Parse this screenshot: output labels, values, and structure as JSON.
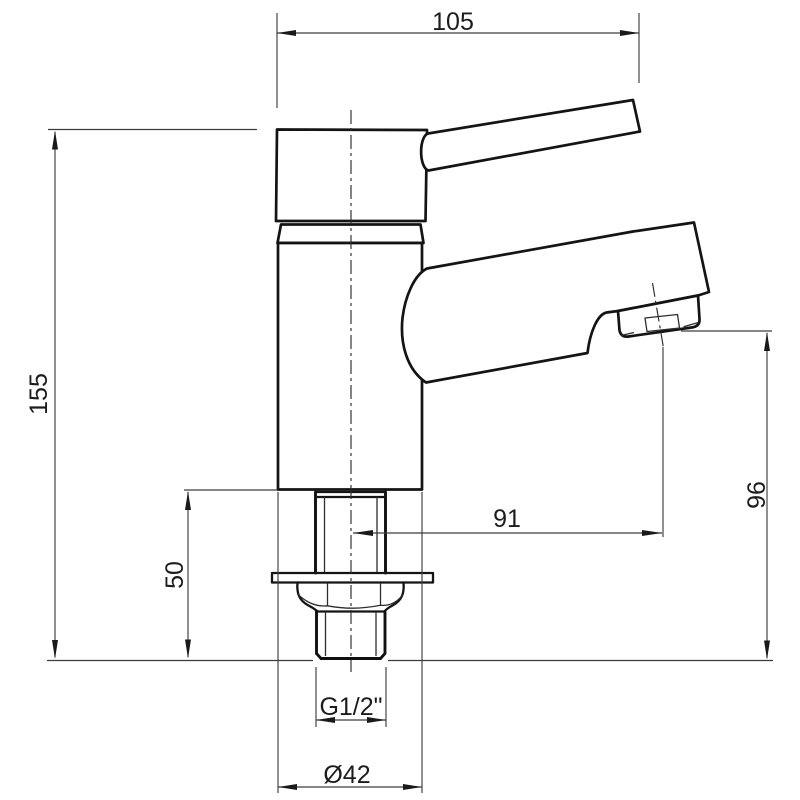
{
  "drawing": {
    "description": "Basin tap technical line drawing with dimensions",
    "background_color": "#ffffff",
    "outline_color": "#141414",
    "dimension_line_color": "#3d3d3d",
    "text_color": "#1c1c1c",
    "units": "mm",
    "dimensions": {
      "handle_width": {
        "label": "105"
      },
      "total_height": {
        "label": "155"
      },
      "shank_height": {
        "label": "50"
      },
      "spout_reach": {
        "label": "91"
      },
      "spout_outlet_height": {
        "label": "96"
      },
      "thread_size": {
        "label": "G1/2\""
      },
      "base_diameter": {
        "label": "Ø42"
      }
    }
  }
}
